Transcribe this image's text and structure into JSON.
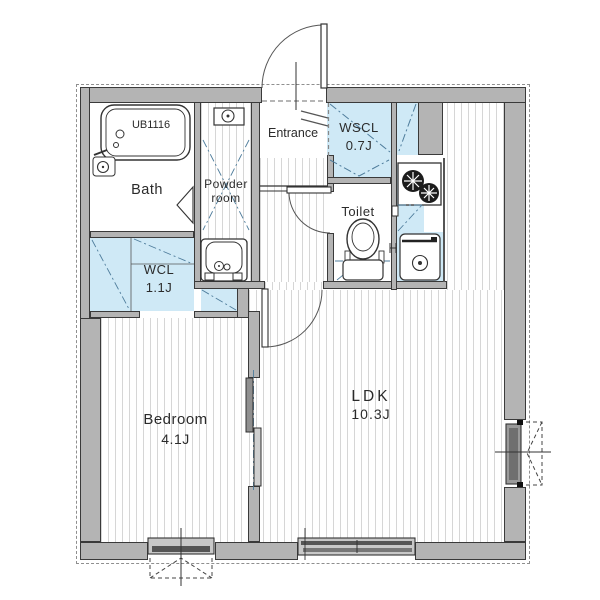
{
  "floorplan": {
    "rooms": {
      "bath": {
        "name": "Bath",
        "fixture_model": "UB1116"
      },
      "powder_room": {
        "name_line1": "Powder",
        "name_line2": "room"
      },
      "entrance": {
        "name": "Entrance"
      },
      "wscl": {
        "name": "WSCL",
        "area": "0.7J"
      },
      "toilet": {
        "name": "Toilet"
      },
      "wcl": {
        "name": "WCL",
        "area": "1.1J"
      },
      "bedroom": {
        "name": "Bedroom",
        "area": "4.1J"
      },
      "ldk": {
        "name": "LDK",
        "area": "10.3J"
      }
    },
    "colors": {
      "wall_fill": "#b4b4b4",
      "wall_line": "#3a3a3a",
      "closet_blue": "#cfe9f6",
      "floor_stripe": "#d6d6d6",
      "door_marker_blue": "#4f7d9c",
      "background": "#ffffff"
    }
  }
}
